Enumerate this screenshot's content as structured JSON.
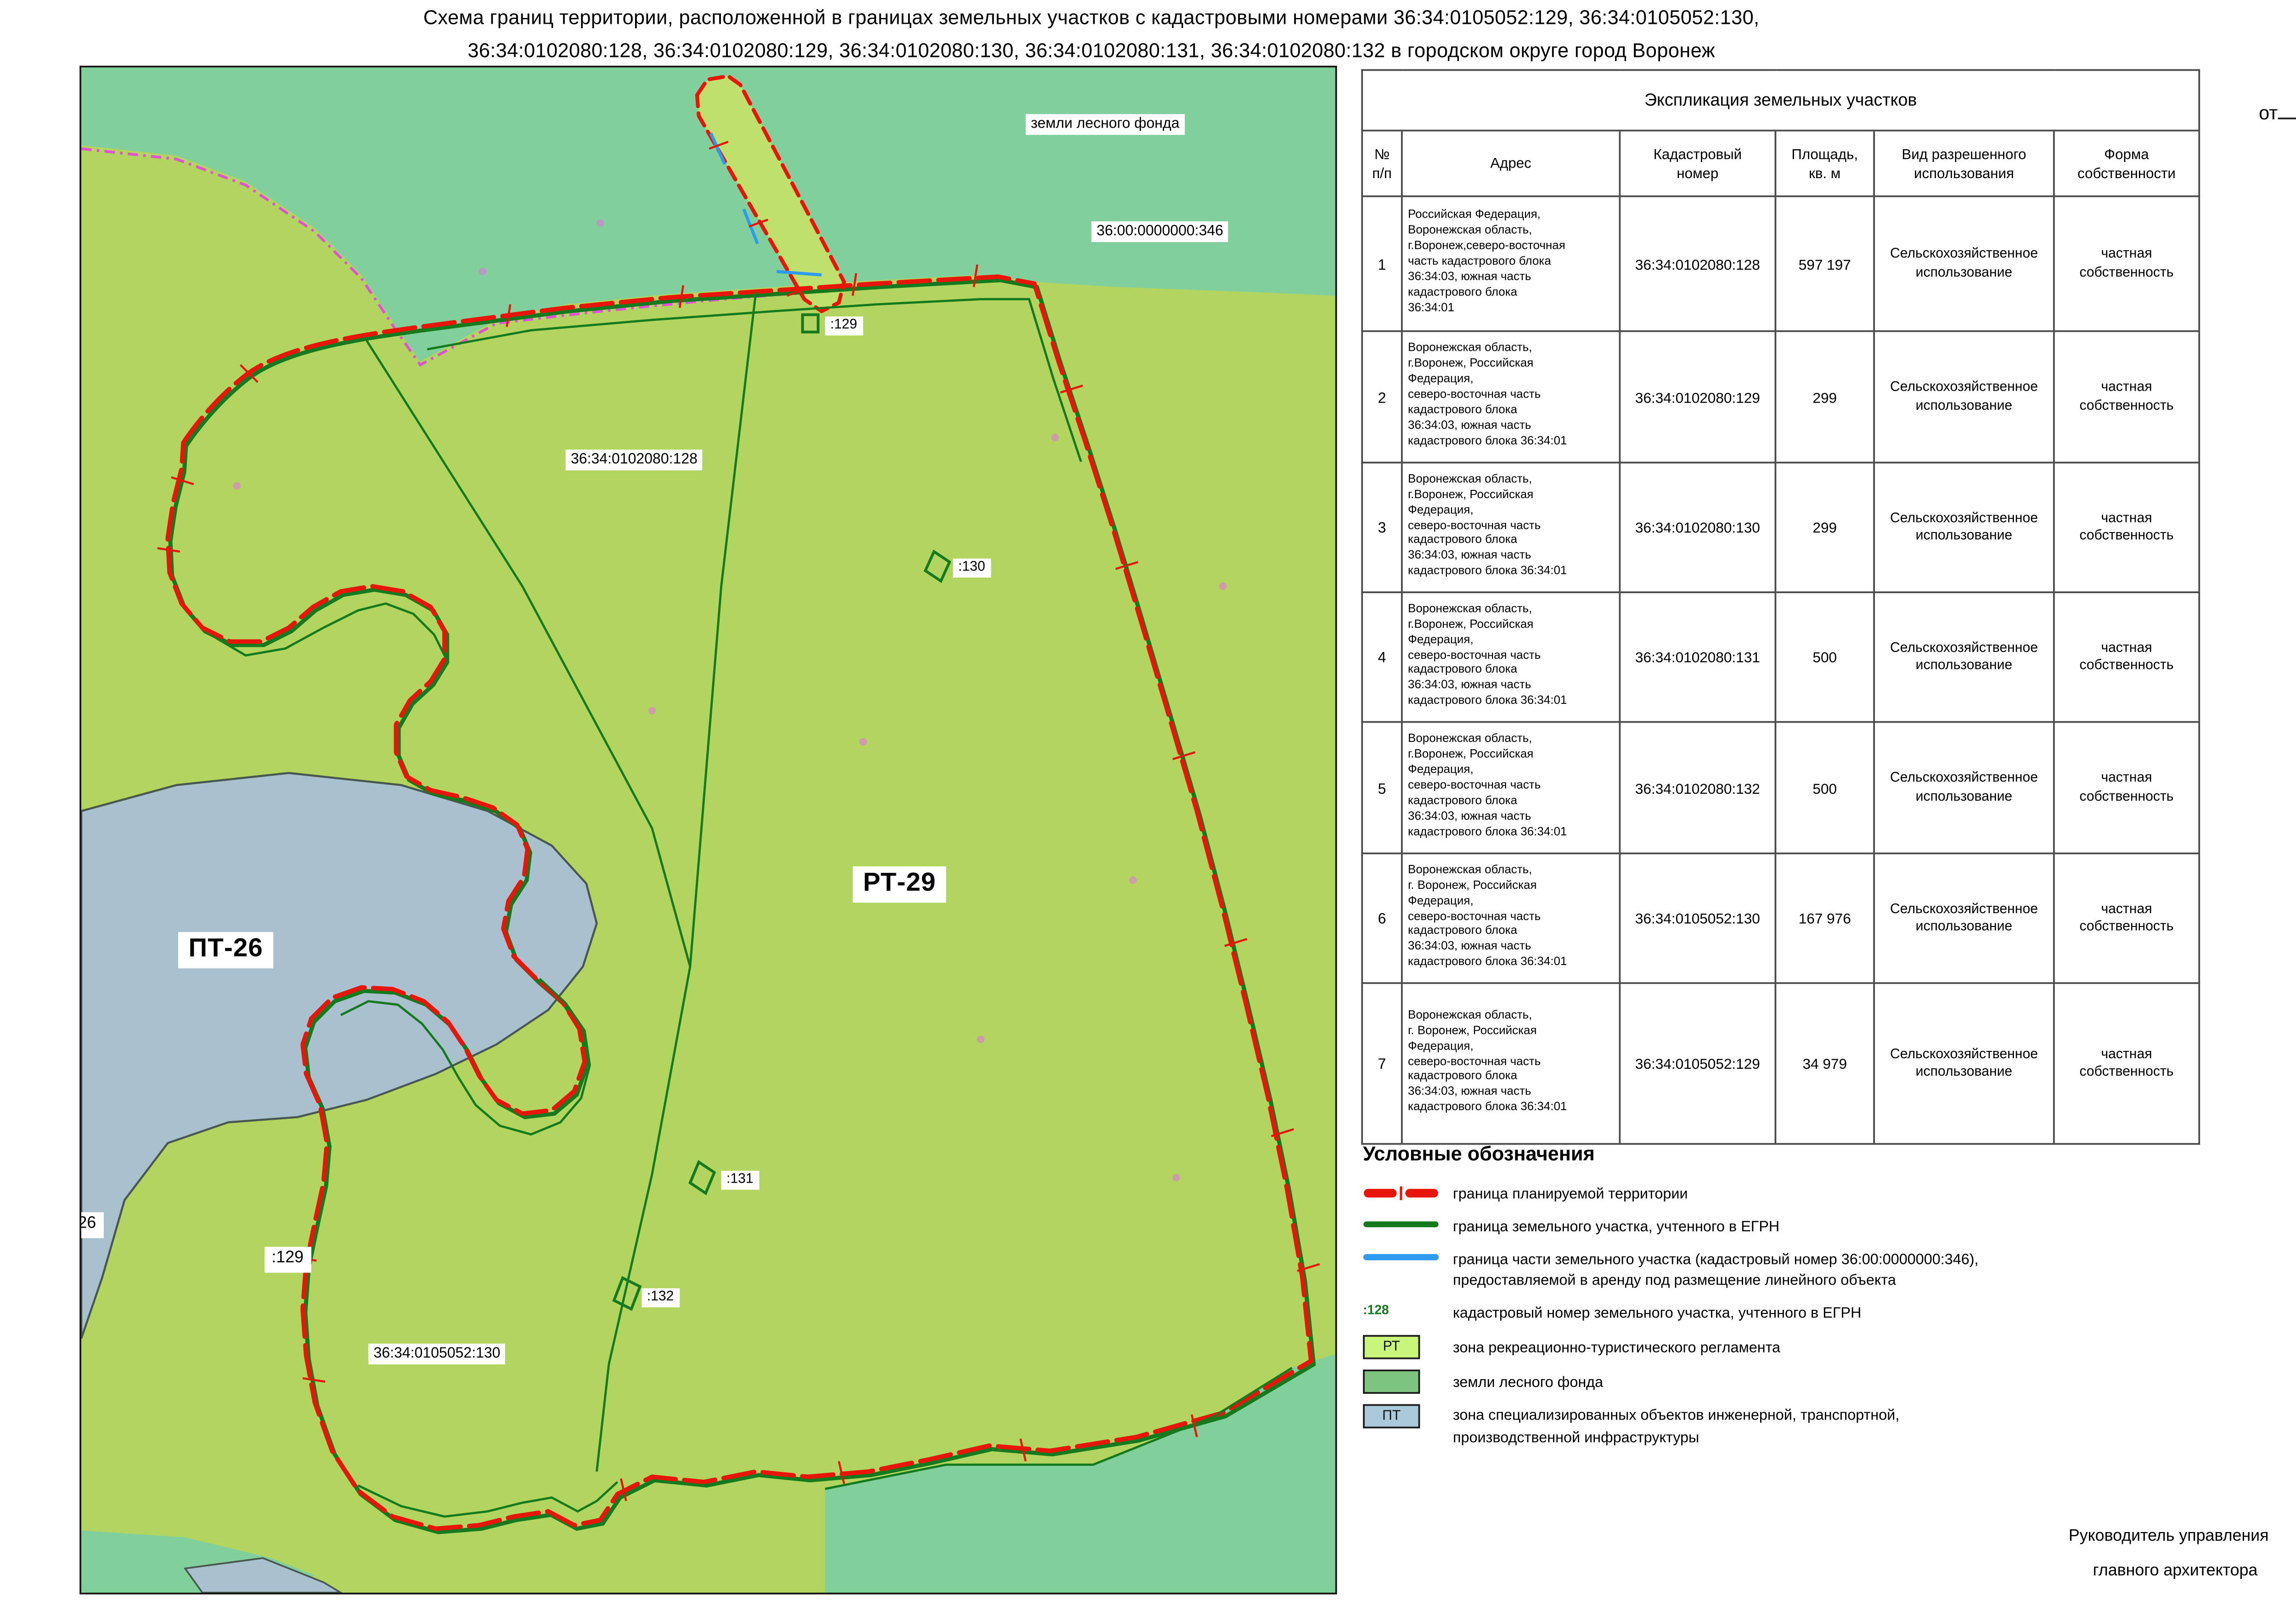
{
  "title": {
    "line1": "Схема границ территории, расположенной в границах земельных участков с кадастровыми номерами 36:34:0105052:129, 36:34:0105052:130,",
    "line2": "36:34:0102080:128, 36:34:0102080:129, 36:34:0102080:130, 36:34:0102080:131, 36:34:0102080:132 в городском округе город Воронеж"
  },
  "annex": {
    "line1": "Приложение",
    "line2": "к постановлению администрации",
    "line3": "городского округа город Воронеж",
    "from_label": "от",
    "no_label": "№"
  },
  "map": {
    "labels": {
      "forest": "земли лесного фонда",
      "cad_346": "36:00:0000000:346",
      "parcel_128": "36:34:0102080:128",
      "parcel_129_top": ":129",
      "parcel_130": ":130",
      "zone_rt": "РТ-29",
      "zone_pt": "ПТ-26",
      "parcel_131": ":131",
      "parcel_129_bottom": ":129",
      "parcel_132": ":132",
      "parcel_105052_130": "36:34:0105052:130",
      "edge_26": "26"
    }
  },
  "table": {
    "title": "Экспликация земельных участков",
    "headers": [
      "№\nп/п",
      "Адрес",
      "Кадастровый\nномер",
      "Площадь,\nкв. м",
      "Вид разрешенного\nиспользования",
      "Форма\nсобственности"
    ],
    "rows": [
      {
        "num": "1",
        "address": "Российская Федерация,\nВоронежская область,\nг.Воронеж,северо-восточная\nчасть кадастрового блока\n36:34:03, южная часть\nкадастрового блока\n36:34:01",
        "cadastral": "36:34:0102080:128",
        "area": "597 197",
        "use": "Сельскохозяйственное\nиспользование",
        "ownership": "частная\nсобственность"
      },
      {
        "num": "2",
        "address": "Воронежская область,\nг.Воронеж, Российская\nФедерация,\nсеверо-восточная часть\nкадастрового блока\n36:34:03, южная часть\nкадастрового блока 36:34:01",
        "cadastral": "36:34:0102080:129",
        "area": "299",
        "use": "Сельскохозяйственное\nиспользование",
        "ownership": "частная\nсобственность"
      },
      {
        "num": "3",
        "address": "Воронежская область,\nг.Воронеж, Российская\nФедерация,\nсеверо-восточная часть\nкадастрового блока\n36:34:03, южная часть\nкадастрового блока 36:34:01",
        "cadastral": "36:34:0102080:130",
        "area": "299",
        "use": "Сельскохозяйственное\nиспользование",
        "ownership": "частная\nсобственность"
      },
      {
        "num": "4",
        "address": "Воронежская область,\nг.Воронеж, Российская\nФедерация,\nсеверо-восточная часть\nкадастрового блока\n36:34:03, южная часть\nкадастрового блока 36:34:01",
        "cadastral": "36:34:0102080:131",
        "area": "500",
        "use": "Сельскохозяйственное\nиспользование",
        "ownership": "частная\nсобственность"
      },
      {
        "num": "5",
        "address": "Воронежская область,\nг.Воронеж, Российская\nФедерация,\nсеверо-восточная часть\nкадастрового блока\n36:34:03, южная часть\nкадастрового блока 36:34:01",
        "cadastral": "36:34:0102080:132",
        "area": "500",
        "use": "Сельскохозяйственное\nиспользование",
        "ownership": "частная\nсобственность"
      },
      {
        "num": "6",
        "address": "Воронежская область,\nг. Воронеж, Российская\nФедерация,\nсеверо-восточная часть\nкадастрового блока\n36:34:03, южная часть\nкадастрового блока 36:34:01",
        "cadastral": "36:34:0105052:130",
        "area": "167 976",
        "use": "Сельскохозяйственное\nиспользование",
        "ownership": "частная\nсобственность"
      },
      {
        "num": "7",
        "address": "Воронежская область,\nг. Воронеж, Российская\nФедерация,\nсеверо-восточная часть\nкадастрового блока\n36:34:03, южная часть\nкадастрового блока 36:34:01",
        "cadastral": "36:34:0105052:129",
        "area": "34 979",
        "use": "Сельскохозяйственное\nиспользование",
        "ownership": "частная\nсобственность"
      }
    ]
  },
  "legend": {
    "title": "Условные обозначения",
    "items": [
      {
        "symbol": "red-dashed-line",
        "label": "граница планируемой территории"
      },
      {
        "symbol": "green-line",
        "label": "граница земельного участка, учтенного в ЕГРН"
      },
      {
        "symbol": "blue-line",
        "label": "граница части земельного участка (кадастровый номер 36:00:0000000:346),\nпредоставляемой в аренду под размещение линейного объекта"
      },
      {
        "symbol": ":128",
        "label": "кадастровый номер земельного участка, учтенного в ЕГРН"
      }
    ],
    "zones": [
      {
        "code": "РТ",
        "label": "зона рекреационно-туристического регламента"
      },
      {
        "code": "",
        "label": "земли лесного фонда"
      },
      {
        "code": "ПТ",
        "label": "зона специализированных объектов инженерной, транспортной,\nпроизводственной инфраструктуры"
      }
    ]
  },
  "signature": {
    "left_line1": "Руководитель управления",
    "left_line2": "главного архитектора",
    "name": "Г.Ю. Чурсанов"
  },
  "colors": {
    "planned_boundary_red": "#e8150b",
    "egrn_green": "#157a1e",
    "linear_object_blue": "#2e9bf0",
    "rt_zone_fill": "#b1d55f",
    "rt_legend_fill": "#c8f57a",
    "forest_fill": "#81cf9b",
    "pt_zone_fill": "#a9c0cf",
    "forest_edge_magenta": "#e93de9"
  }
}
